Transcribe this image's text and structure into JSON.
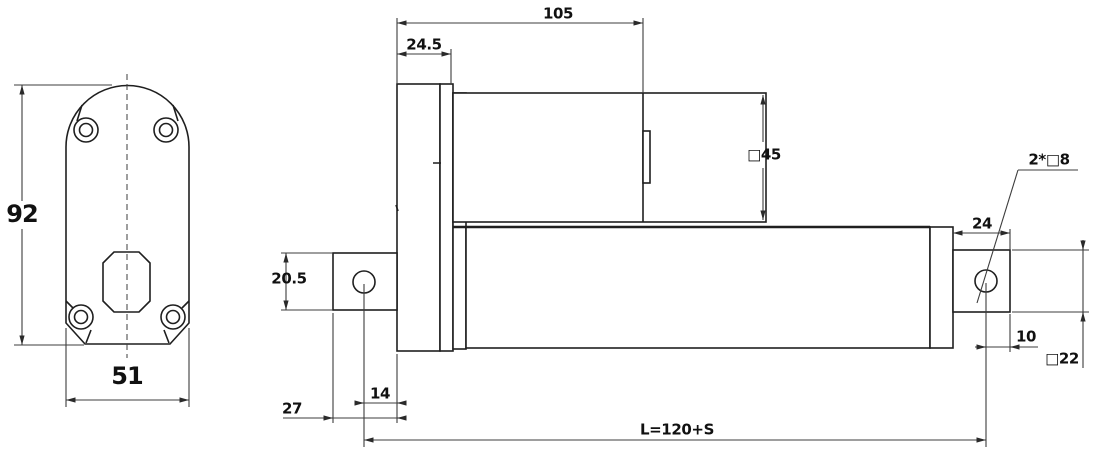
{
  "drawing": {
    "type": "technical-dimension-drawing",
    "subject": "linear-actuator",
    "units": "mm",
    "front_view": {
      "height": "92",
      "width": "51"
    },
    "side_view": {
      "housing_length": "105",
      "mount_plate_thickness": "24.5",
      "motor_square_size": "□45",
      "rear_clevis_height": "20.5",
      "rear_clevis_depth": "27",
      "rear_hole_to_plate": "14",
      "front_clevis_length": "24",
      "front_hole_to_end": "10",
      "front_clevis_square": "□22",
      "clevis_holes": "2*□8",
      "retracted_length": "L=120+S"
    }
  }
}
